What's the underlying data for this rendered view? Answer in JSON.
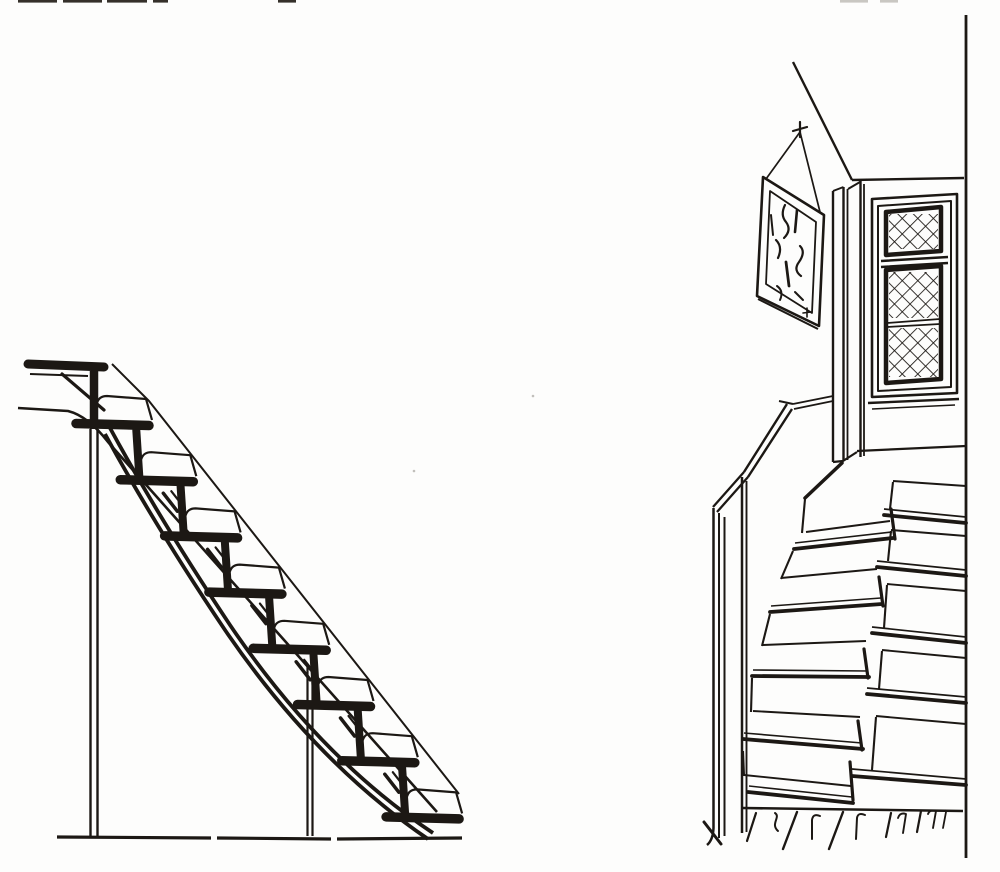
{
  "palette": {
    "ink": "#1c1814",
    "paper": "#fdfdfc",
    "faint_mark": "#c9c7c2",
    "dark_mark": "#35302a"
  },
  "left_figure": {
    "label": "open-ladder-staircase-side-elevation",
    "steps": {
      "count": 8,
      "x0": 73,
      "y0": 419,
      "dx": 44.3,
      "dy": 56.2,
      "tread_length": 73,
      "tick_first": 1,
      "tick_last": 6
    }
  },
  "right_figure": {
    "label": "interior-quarter-turn-staircase-perspective",
    "wall_steps": [
      {
        "back": [
          893,
          481,
          966,
          486
        ],
        "cap": [
          893,
          482,
          890,
          509
        ],
        "nose_thin": [
          884,
          509,
          966,
          517
        ],
        "nose": [
          884,
          515,
          966,
          523
        ]
      },
      {
        "back": [
          891,
          530,
          966,
          536
        ],
        "cap": [
          891,
          531,
          888,
          561
        ],
        "nose_thin": [
          877,
          561,
          966,
          570
        ],
        "nose": [
          877,
          567,
          966,
          576
        ]
      },
      {
        "back": [
          887,
          584,
          966,
          591
        ],
        "cap": [
          887,
          585,
          884,
          628
        ],
        "nose_thin": [
          872,
          627,
          966,
          637
        ],
        "nose": [
          872,
          633,
          966,
          643
        ]
      },
      {
        "back": [
          882,
          650,
          966,
          658
        ],
        "cap": [
          882,
          651,
          879,
          689
        ],
        "nose_thin": [
          867,
          688,
          966,
          697
        ],
        "nose": [
          867,
          694,
          966,
          703
        ]
      },
      {
        "back": [
          876,
          716,
          966,
          724
        ],
        "cap": [
          876,
          717,
          872,
          770
        ],
        "nose_thin": [
          852,
          769,
          966,
          779
        ],
        "nose": [
          852,
          776,
          966,
          785
        ]
      }
    ],
    "winder_steps": [
      {
        "back": [
          806,
          532,
          890,
          521
        ],
        "nose_thin": [
          795,
          543,
          892,
          532
        ],
        "nose": [
          794,
          549,
          893,
          538
        ],
        "edge": [
          805,
          499,
          802,
          533
        ],
        "cap": [
          891,
          509,
          895,
          539
        ]
      },
      {
        "back": [
          781,
          578,
          877,
          569
        ],
        "nose_thin": [
          771,
          606,
          881,
          598
        ],
        "nose": [
          770,
          612,
          882,
          604
        ],
        "edge": [
          793,
          551,
          781,
          579
        ],
        "cap": [
          879,
          577,
          883,
          606
        ]
      },
      {
        "back": [
          763,
          645,
          866,
          641
        ],
        "nose_thin": [
          753,
          670,
          868,
          671
        ],
        "nose": [
          752,
          676,
          869,
          677
        ],
        "edge": [
          770,
          614,
          762,
          646
        ],
        "cap": [
          864,
          649,
          868,
          678
        ]
      },
      {
        "back": [
          753,
          711,
          860,
          717
        ],
        "nose_thin": [
          744,
          733,
          862,
          743
        ],
        "nose": [
          743,
          739,
          863,
          749
        ],
        "edge": [
          752,
          678,
          751,
          712
        ],
        "cap": [
          858,
          721,
          862,
          750
        ]
      },
      {
        "back": [
          744,
          775,
          851,
          786
        ],
        "nose_thin": [
          749,
          786,
          852,
          797
        ],
        "nose": [
          748,
          792,
          853,
          803
        ],
        "edge": [
          743,
          751,
          744,
          776
        ],
        "cap": [
          850,
          762,
          853,
          800
        ]
      }
    ],
    "floor_line": [
      743,
      808,
      963,
      811
    ]
  },
  "artifacts": {
    "top_edge_marks": [
      {
        "x": 18,
        "w": 39,
        "dark": true
      },
      {
        "x": 63,
        "w": 39,
        "dark": true
      },
      {
        "x": 107,
        "w": 40,
        "dark": true
      },
      {
        "x": 153,
        "w": 15,
        "dark": true
      },
      {
        "x": 278,
        "w": 18,
        "dark": true
      },
      {
        "x": 840,
        "w": 28,
        "dark": false
      },
      {
        "x": 880,
        "w": 18,
        "dark": false
      }
    ],
    "paper_specks": [
      [
        414,
        471
      ],
      [
        533,
        396
      ]
    ]
  }
}
